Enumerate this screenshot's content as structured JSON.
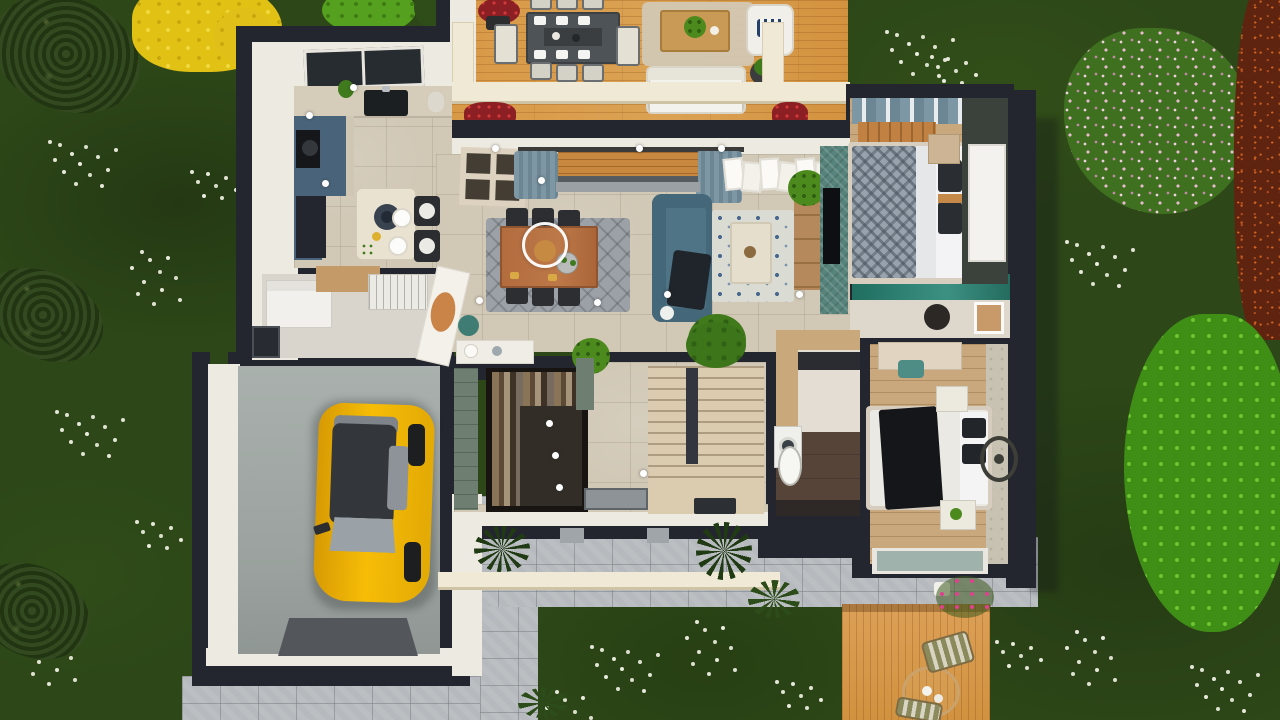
{
  "app": {
    "title": "3D house floor plan — top-down render"
  },
  "palette": {
    "grass": "#2d4718",
    "wall": "#24262f",
    "wall_face": "#edeae1",
    "floor_tile": "#d1c8b6",
    "wood_deck": "#d89946",
    "stone_path": "#b6babe",
    "kitchen_cabinet": "#49647a",
    "sofa_teal": "#4e7486",
    "tv_accent_wall": "#56837b",
    "car_yellow": "#f2b705",
    "stairs_wood": "#dbcbaf",
    "shower_teal": "#2a7a6c",
    "selection_ring": "#ffffff"
  },
  "garden": {
    "lawn": "dark green grass with scattered small white flowers",
    "trees": [
      {
        "name": "cypress-tree-top-left",
        "color": "#2c431c"
      },
      {
        "name": "cypress-tree-mid-left",
        "color": "#2c431c"
      },
      {
        "name": "cypress-tree-bottom-left",
        "color": "#2c431c"
      },
      {
        "name": "yellow-maple-tree",
        "color": "#e2c115"
      },
      {
        "name": "green-shrub-top",
        "color": "#55a01e"
      },
      {
        "name": "pink-flowering-shrub-top-right",
        "color": "#d9a9c4"
      },
      {
        "name": "red-leaf-tree-right-edge",
        "color": "#8a3a1a"
      },
      {
        "name": "pink-flower-tree-right",
        "color": "#4aa21f"
      }
    ],
    "hardscape": [
      "stone paver driveway below garage",
      "stone walkway along south facade",
      "cream pergola beam over walkway"
    ],
    "terraces": [
      {
        "name": "main-terrace",
        "label": "Main terrace",
        "furniture": [
          "outdoor dining table with 8 chairs",
          "white lounge sofa",
          "white armchair with striped pillow",
          "wood coffee table with plant",
          "beige outdoor rug",
          "potted plants",
          "red flower boxes",
          "pergola posts and beam"
        ]
      },
      {
        "name": "small-terrace",
        "label": "Garden terrace",
        "furniture": [
          "round bistro table",
          "two chairs with olive cushions",
          "pink bougainvillea in pot"
        ]
      }
    ]
  },
  "house": {
    "style": "modern single-storey home, dark roof-cut walls, white facades, top-down 3D view",
    "rooms": [
      {
        "id": "kitchen",
        "label": "Kitchen",
        "features": [
          "skylight",
          "blue-grey cabinets and island",
          "black sink",
          "black hob",
          "dark pantry",
          "breakfast table with two plates and two wire chairs"
        ]
      },
      {
        "id": "utility",
        "label": "Utility room",
        "features": [
          "white washer cabinet",
          "wood counter",
          "drying rack",
          "west window"
        ]
      },
      {
        "id": "living_dining",
        "label": "Living / dining room",
        "features": [
          "wood dining table",
          "six black chairs",
          "grey rug",
          "teal sofa with dark throw",
          "patterned blue rug",
          "cream coffee table",
          "TV on teal accent wall",
          "wood TV console",
          "bookshelf",
          "blue curtains at sliding door",
          "gallery pictures",
          "indoor plants"
        ]
      },
      {
        "id": "entry",
        "label": "Entry hall",
        "features": [
          "white angled partition",
          "terracotta mirror",
          "teal pouf",
          "white console"
        ]
      },
      {
        "id": "closet",
        "label": "Walk-in closet",
        "features": [
          "dark wardrobe full of clothes",
          "green tiled wall"
        ]
      },
      {
        "id": "stairs",
        "label": "Staircase",
        "features": [
          "light wood treads",
          "dark handrail",
          "doormat",
          "potted plant"
        ]
      },
      {
        "id": "bathroom",
        "label": "Bathroom / laundry",
        "features": [
          "washing machine",
          "white sink",
          "dark tile floor",
          "dark vanity counter"
        ]
      },
      {
        "id": "master_bedroom",
        "label": "Master bedroom",
        "features": [
          "double bed with grey patterned duvet",
          "white and charcoal pillows",
          "wood slat headboard",
          "blue window curtains",
          "dark accent wall with white wardrobe",
          "nightstand"
        ]
      },
      {
        "id": "ensuite",
        "label": "En-suite shower room",
        "features": [
          "teal glass shower",
          "dark stool",
          "leaning framed picture"
        ]
      },
      {
        "id": "bedroom2",
        "label": "Bedroom 2",
        "features": [
          "double bed white duvet with black throw",
          "desk with teal chair",
          "two white nightstands",
          "stone floor strip with round medallion",
          "glass door to garden"
        ]
      },
      {
        "id": "garage",
        "label": "Garage",
        "features": [
          "yellow hatchback car",
          "grey concrete floor",
          "dark entry ramp"
        ]
      }
    ],
    "lighting": "recessed ceiling spotlights shown as white dots"
  },
  "vehicle": {
    "name": "yellow-hatchback-car",
    "body_color": "#f2b705",
    "roof": "dark glass roof",
    "orientation": "nose toward driveway (south)"
  },
  "ui": {
    "selection_ring": {
      "cx": 545,
      "cy": 245,
      "radius": 23,
      "color": "#ffffff",
      "note": "white circular selection indicator over dining table"
    }
  }
}
